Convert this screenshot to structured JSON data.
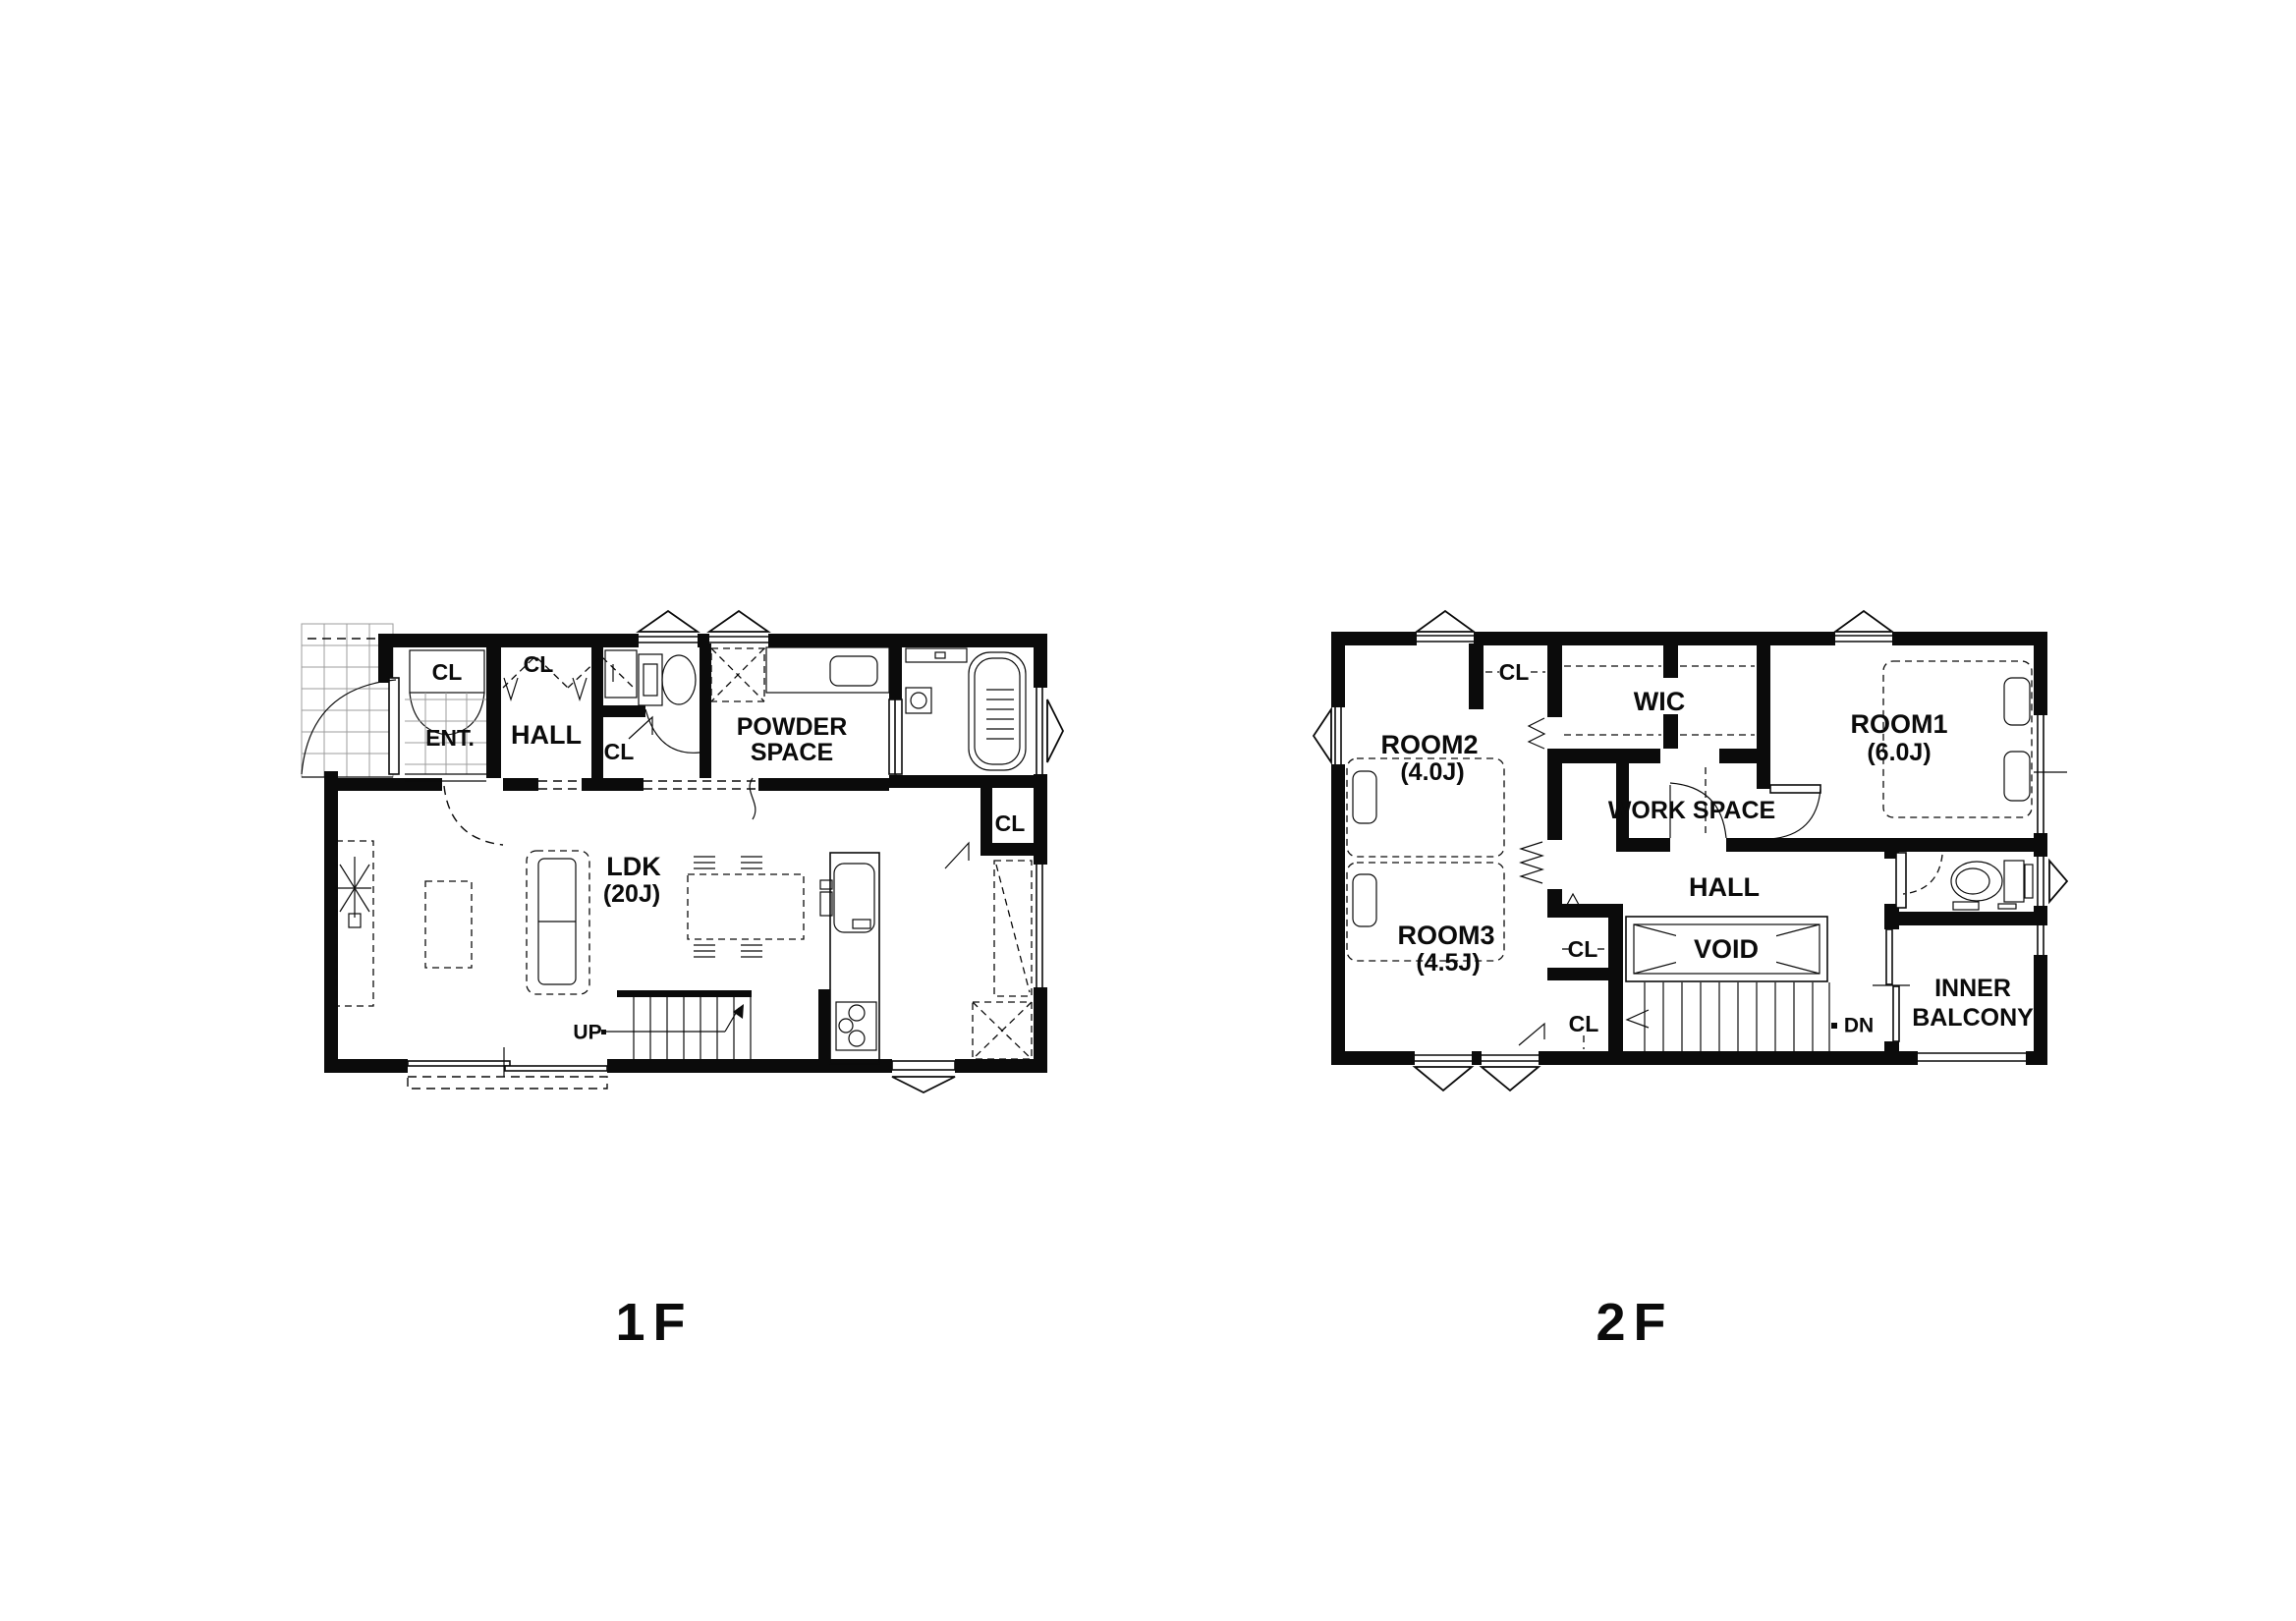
{
  "floor1": {
    "caption": "1F",
    "labels": {
      "ent": "ENT.",
      "cl_ent": "CL",
      "hall": "HALL",
      "cl_hall": "CL",
      "cl_wc": "CL",
      "powder1": "POWDER",
      "powder2": "SPACE",
      "cl_bath": "CL",
      "ldk": "LDK",
      "ldk_size": "(20J)",
      "up": "UP"
    }
  },
  "floor2": {
    "caption": "2F",
    "labels": {
      "room2": "ROOM2",
      "room2_size": "(4.0J)",
      "cl_room2": "CL",
      "wic": "WIC",
      "room1": "ROOM1",
      "room1_size": "(6.0J)",
      "work_space": "WORK SPACE",
      "hall": "HALL",
      "room3": "ROOM3",
      "room3_size": "(4.5J)",
      "cl_upper": "CL",
      "cl_lower": "CL",
      "void": "VOID",
      "dn": "DN",
      "balcony1": "INNER",
      "balcony2": "BALCONY"
    }
  },
  "colors": {
    "wall": "#0b0b0b",
    "background": "#ffffff",
    "tile_grid": "#9c9c9c"
  }
}
